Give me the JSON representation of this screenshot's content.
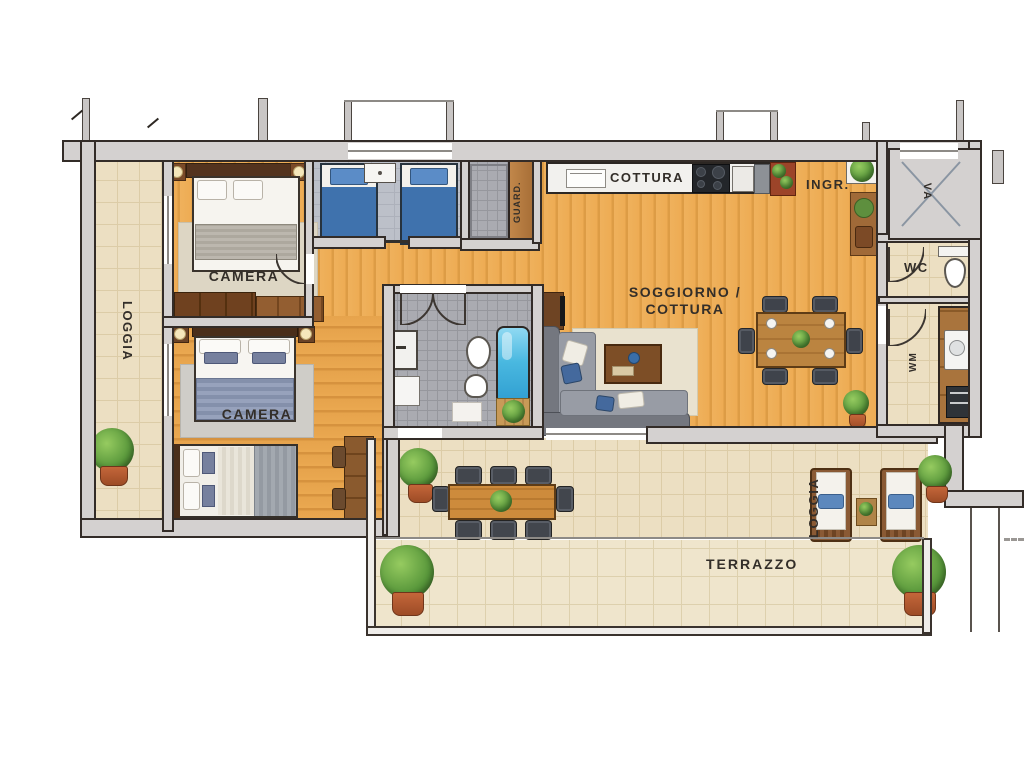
{
  "labels": {
    "camera_top": "CAMERA",
    "camera_mid": "CAMERA",
    "cottura": "COTTURA",
    "ingresso": "INGR.",
    "soggiorno_line1": "SOGGIORNO /",
    "soggiorno_line2": "COTTURA",
    "wc": "WC",
    "terrazzo": "TERRAZZO",
    "loggia_left": "LOGGIA",
    "loggia_bottom": "LOGGIA",
    "wardrobe": "GUARD.",
    "laundry": "WM",
    "elevator": "VA"
  },
  "colors": {
    "wall_fill": "#d4d1d0",
    "wall_line": "#332c28",
    "wood_floor": "#eeac54",
    "tile_beige": "#ecdfc2",
    "tile_grey": "#aaabb1",
    "carpet_grey": "#bcc0c9",
    "bed_blue": "#3f72ad",
    "blanket_blue_grey": "#8d98b2",
    "sofa_grey": "#8d919a",
    "bath_water": "#49b8e0",
    "plant_green": "#57963a",
    "pot_terracotta": "#b05a31",
    "counter_white": "#f2f1ee",
    "label_text": "#332e29"
  }
}
